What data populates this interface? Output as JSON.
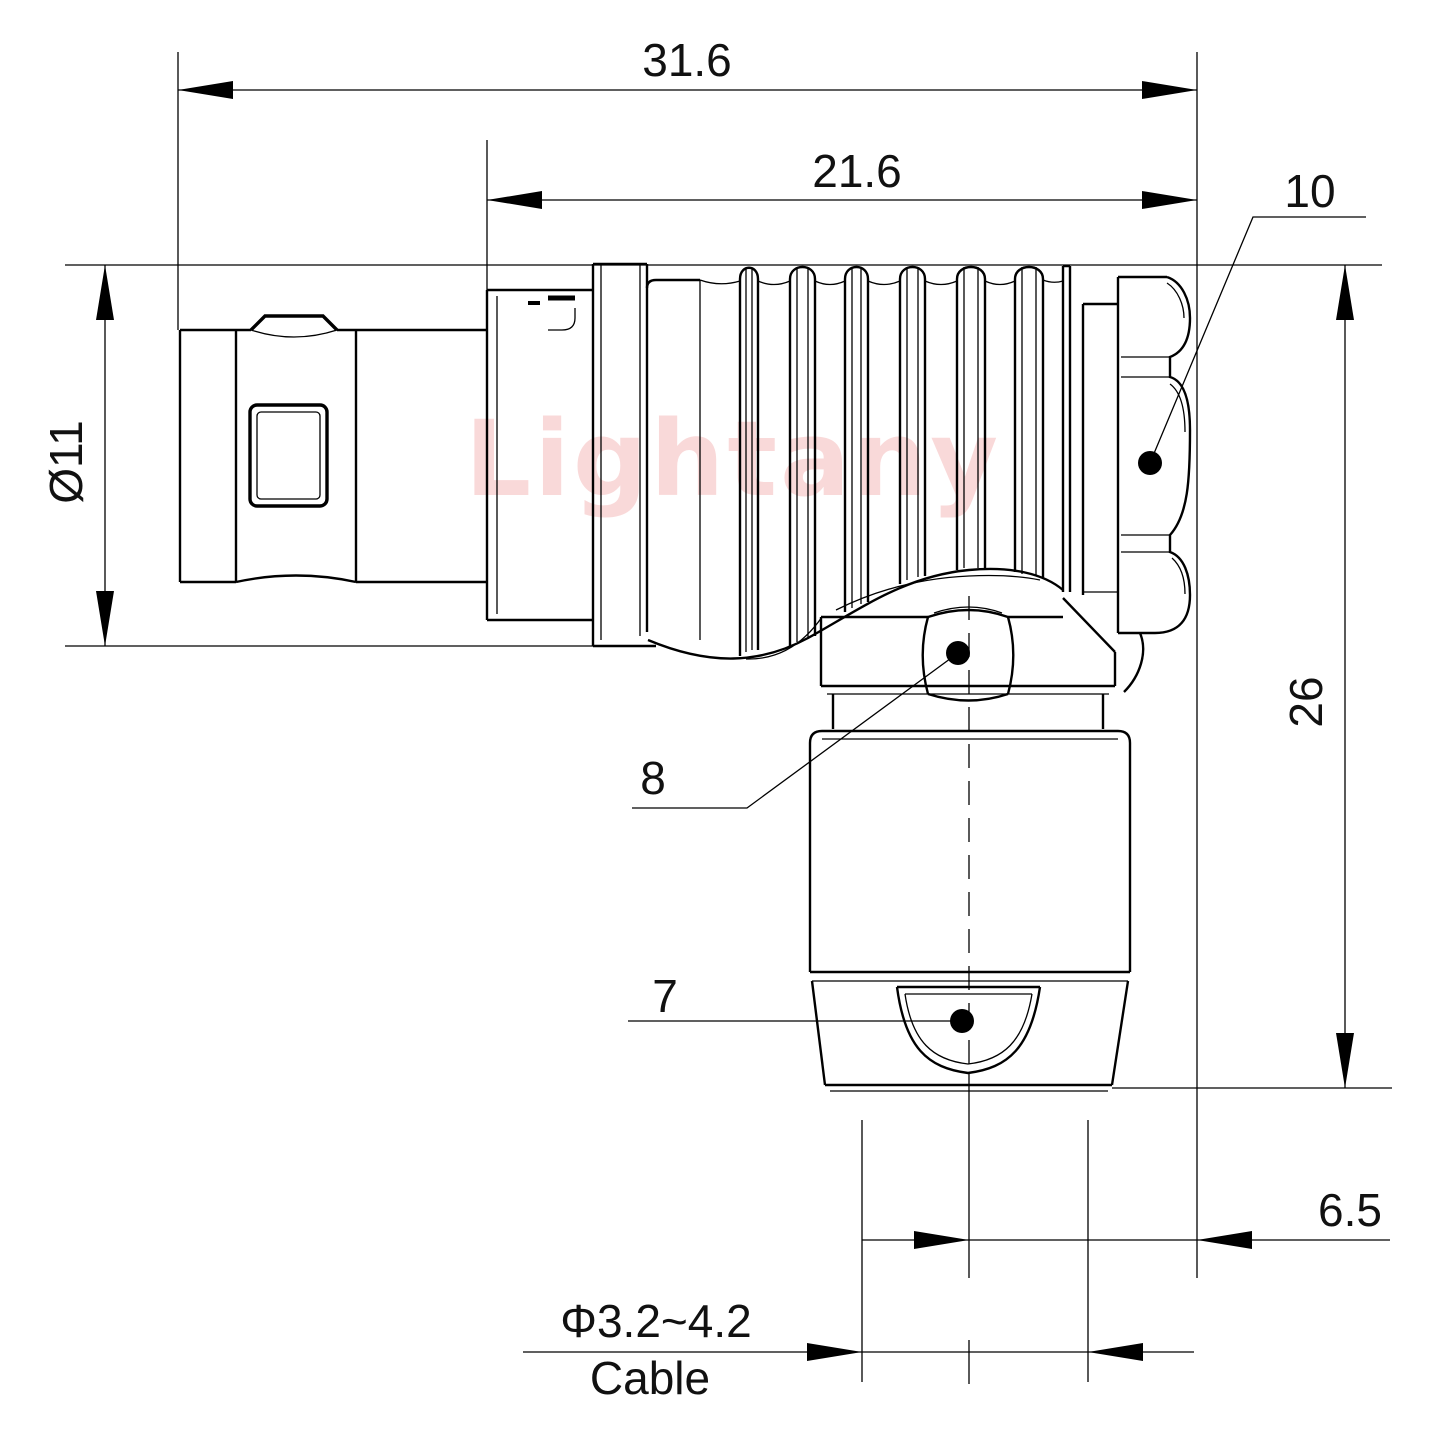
{
  "watermark": "Lightany",
  "dimensions": {
    "overall_length": "31.6",
    "body_length": "21.6",
    "front_diameter": "Ø11",
    "height": "26",
    "cable_center_offset": "6.5",
    "cable_diameter": "Φ3.2~4.2",
    "cable_word": "Cable"
  },
  "callouts": {
    "coupling_nut": "10",
    "hex_backnut": "8",
    "strain_relief": "7"
  }
}
